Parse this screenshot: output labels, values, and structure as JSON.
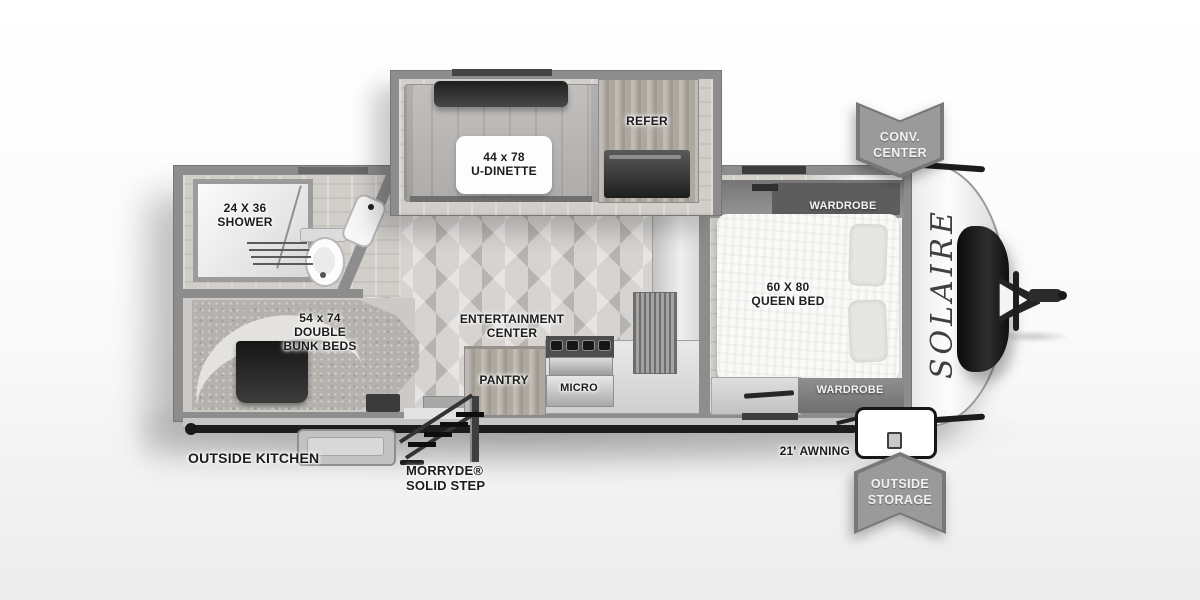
{
  "floorplan": {
    "brand": "SOLAIRE",
    "badges": {
      "conv_center": {
        "line1": "CONV.",
        "line2": "CENTER"
      },
      "outside_storage": {
        "line1": "OUTSIDE",
        "line2": "STORAGE"
      }
    },
    "dinette": {
      "size": "44 x 78",
      "name": "U-DINETTE"
    },
    "refer": {
      "label": "REFER"
    },
    "bathroom": {
      "shower_size": "24 X 36",
      "shower_name": "SHOWER"
    },
    "bunk_room": {
      "size": "54 x 74",
      "name_line1": "DOUBLE",
      "name_line2": "BUNK BEDS"
    },
    "living": {
      "entertainment_line1": "ENTERTAINMENT",
      "entertainment_line2": "CENTER",
      "pantry": "PANTRY",
      "micro": "MICRO"
    },
    "bedroom": {
      "bed_size": "60 X 80",
      "bed_name": "QUEEN BED",
      "wardrobe_top": "WARDROBE",
      "wardrobe_bottom": "WARDROBE"
    },
    "exterior": {
      "outside_kitchen": "OUTSIDE KITCHEN",
      "step_brand": "MORRYDE®",
      "step_name": "SOLID STEP",
      "awning": "21' AWNING"
    }
  },
  "colors": {
    "wall": "#8d8d8d",
    "floor_light": "#d6d3d0",
    "badge_fill": "#9a9a9a",
    "badge_edge": "#787878",
    "awning_bar": "#1d1d1d",
    "brand_text": "#3f3f3f",
    "label_text": "#1c1c1c"
  }
}
